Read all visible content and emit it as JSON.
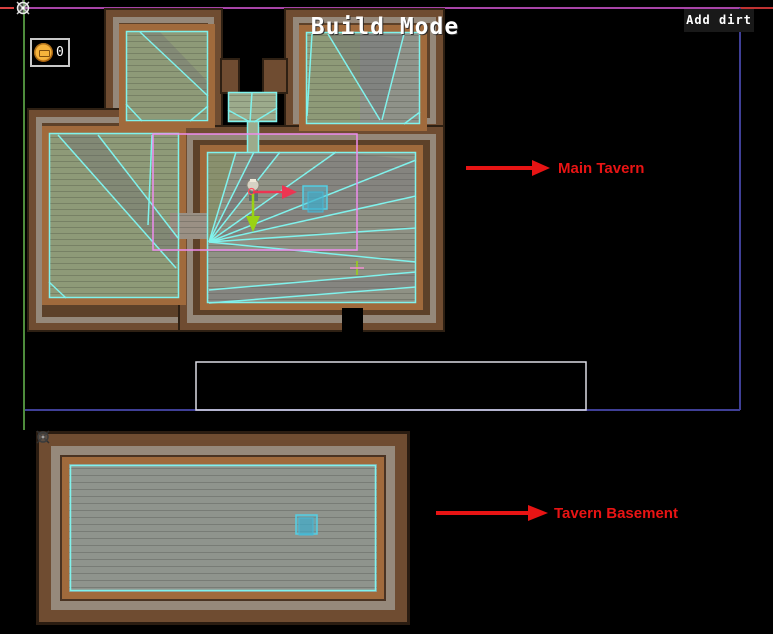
{
  "hud": {
    "title": "Build Mode",
    "add_dirt_button": "Add dirt",
    "coin_counter": {
      "icon": "coin-icon",
      "count": "0"
    }
  },
  "annotations": [
    {
      "label": "Main Tavern",
      "color": "#e81414",
      "arrow": "red-arrow-right"
    },
    {
      "label": "Tavern Basement",
      "color": "#e81414",
      "arrow": "red-arrow-right"
    }
  ],
  "scene": {
    "colors": {
      "navmesh_cyan": "#80f2ec",
      "area_rect_pink": "#ee8cef",
      "bounds_blue": "#3f3f96",
      "bounds_purple": "#a844a8",
      "bounds_red": "#d84040",
      "gizmo_green_axis": "#4e8c3c",
      "move_arrow_red": "#ed3552",
      "move_arrow_green": "#9ad214",
      "wall_brown": "#6f4c31",
      "wall_trim": "#95887a",
      "plank_orange": "#a06a3c",
      "floor_green": "#8e9a78",
      "floor_gray": "#90938c"
    },
    "icons": [
      "move-gizmo-icon",
      "basement-gizmo-icon",
      "coin-icon"
    ]
  }
}
